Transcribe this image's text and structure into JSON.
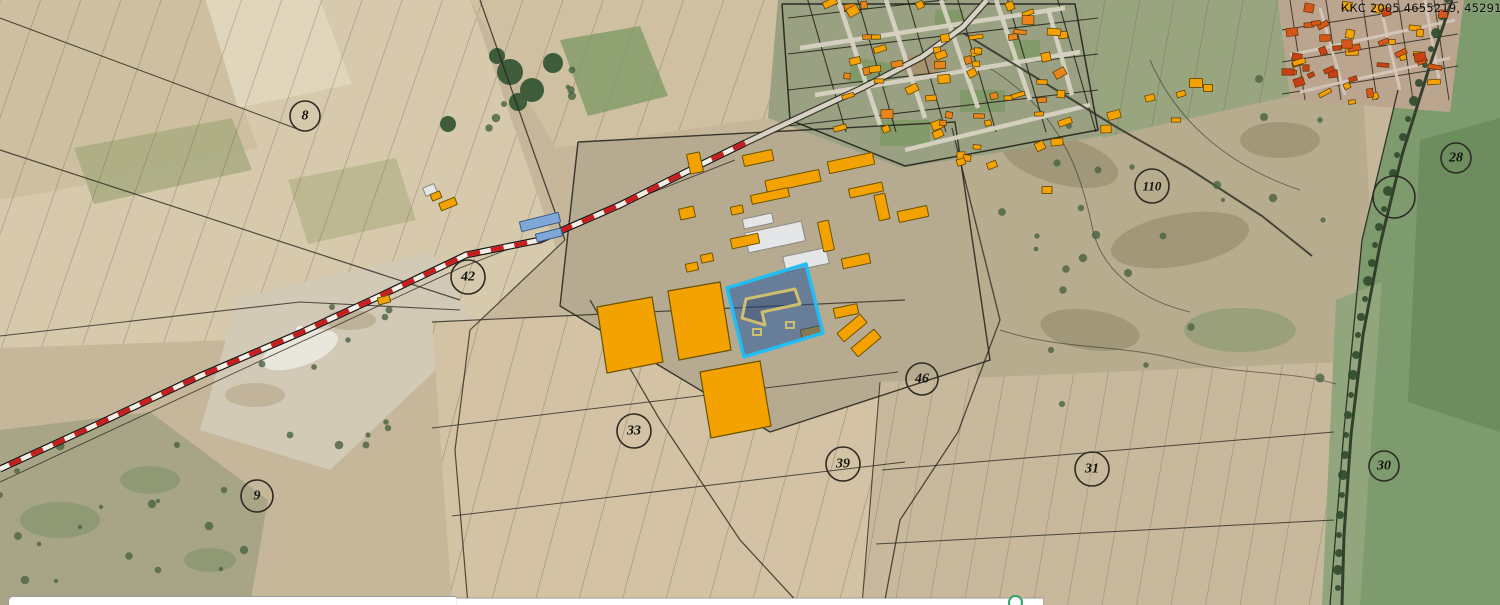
{
  "map": {
    "label_topright": "ККС 2005 4655219, 452916",
    "colors": {
      "building_orange": "#f3a202",
      "building_outline": "#6b5200",
      "town_building_red": "#d8551c",
      "white_shed": "#e4e6e7",
      "blue_shed": "#7fa8d9",
      "selection_stroke": "#22bdf2",
      "selection_fill": "rgba(25,80,160,0.5)",
      "inner_building_stroke": "#cdbf6e",
      "railway_red": "#c81e1e",
      "railway_light": "#f3efe6",
      "boundary": "#21201a",
      "circle_stroke": "#2d2b24",
      "circle_text": "#15140f"
    },
    "parcel_numbers": [
      {
        "label": "8",
        "x": 305,
        "y": 116,
        "r": 15
      },
      {
        "label": "42",
        "x": 468,
        "y": 277,
        "r": 17
      },
      {
        "label": "9",
        "x": 257,
        "y": 496,
        "r": 16
      },
      {
        "label": "33",
        "x": 634,
        "y": 431,
        "r": 17
      },
      {
        "label": "39",
        "x": 843,
        "y": 464,
        "r": 17
      },
      {
        "label": "46",
        "x": 922,
        "y": 379,
        "r": 16
      },
      {
        "label": "110",
        "x": 1152,
        "y": 186,
        "r": 17
      },
      {
        "label": "28",
        "x": 1456,
        "y": 158,
        "r": 15
      },
      {
        "label": "",
        "x": 1394,
        "y": 197,
        "r": 21
      },
      {
        "label": "31",
        "x": 1092,
        "y": 469,
        "r": 17
      },
      {
        "label": "30",
        "x": 1384,
        "y": 466,
        "r": 15
      }
    ],
    "selected_parcel": {
      "polygon": [
        [
          727,
          288
        ],
        [
          806,
          264
        ],
        [
          823,
          333
        ],
        [
          744,
          357
        ]
      ],
      "building_path": "M742,318 L746,299 L795,289 L800,304 L762,312 L765,325 Z",
      "marks": [
        [
          757,
          332
        ],
        [
          790,
          325
        ]
      ]
    },
    "railway_points": [
      [
        745,
        143
      ],
      [
        700,
        165
      ],
      [
        620,
        205
      ],
      [
        540,
        240
      ],
      [
        466,
        255
      ],
      [
        380,
        296
      ],
      [
        300,
        333
      ],
      [
        200,
        376
      ],
      [
        100,
        423
      ],
      [
        0,
        469
      ]
    ],
    "roads": {
      "main": [
        [
          745,
          143
        ],
        [
          802,
          116
        ],
        [
          862,
          88
        ],
        [
          922,
          57
        ],
        [
          963,
          27
        ],
        [
          987,
          0
        ]
      ],
      "east": [
        [
          963,
          33
        ],
        [
          1040,
          80
        ],
        [
          1118,
          128
        ],
        [
          1188,
          168
        ],
        [
          1262,
          216
        ],
        [
          1312,
          256
        ]
      ],
      "right": [
        [
          1452,
          0
        ],
        [
          1430,
          65
        ],
        [
          1402,
          155
        ],
        [
          1380,
          245
        ],
        [
          1363,
          335
        ],
        [
          1351,
          435
        ],
        [
          1344,
          535
        ],
        [
          1342,
          605
        ]
      ]
    },
    "village_streets": [
      [
        [
          838,
          0
        ],
        [
          880,
          125
        ]
      ],
      [
        [
          886,
          0
        ],
        [
          925,
          118
        ]
      ],
      [
        [
          941,
          0
        ],
        [
          978,
          108
        ]
      ],
      [
        [
          996,
          0
        ],
        [
          1030,
          100
        ]
      ],
      [
        [
          1048,
          8
        ],
        [
          1072,
          95
        ]
      ],
      [
        [
          800,
          48
        ],
        [
          1065,
          8
        ]
      ],
      [
        [
          815,
          95
        ],
        [
          1080,
          52
        ]
      ],
      [
        [
          905,
          150
        ],
        [
          1090,
          105
        ]
      ]
    ],
    "town_streets": [
      [
        [
          1290,
          55
        ],
        [
          1455,
          20
        ]
      ],
      [
        [
          1300,
          92
        ],
        [
          1450,
          58
        ]
      ],
      [
        [
          1320,
          8
        ],
        [
          1345,
          95
        ]
      ],
      [
        [
          1380,
          5
        ],
        [
          1400,
          90
        ]
      ],
      [
        [
          1425,
          0
        ],
        [
          1440,
          85
        ]
      ]
    ],
    "orange_parcels": [
      [
        [
          597,
          307
        ],
        [
          652,
          297
        ],
        [
          663,
          362
        ],
        [
          607,
          373
        ]
      ],
      [
        [
          668,
          291
        ],
        [
          720,
          282
        ],
        [
          731,
          350
        ],
        [
          679,
          360
        ]
      ],
      [
        [
          700,
          372
        ],
        [
          760,
          361
        ],
        [
          771,
          426
        ],
        [
          711,
          438
        ]
      ]
    ],
    "orange_sheds": [
      [
        695,
        163,
        13,
        20,
        -12
      ],
      [
        758,
        158,
        30,
        11,
        -12
      ],
      [
        793,
        181,
        55,
        12,
        -12
      ],
      [
        770,
        196,
        38,
        9,
        -12
      ],
      [
        851,
        163,
        46,
        12,
        -12
      ],
      [
        866,
        190,
        34,
        9,
        -12
      ],
      [
        882,
        207,
        11,
        26,
        -12
      ],
      [
        913,
        214,
        30,
        11,
        -12
      ],
      [
        687,
        213,
        15,
        11,
        -12
      ],
      [
        692,
        267,
        12,
        8,
        -12
      ],
      [
        707,
        258,
        12,
        8,
        -12
      ],
      [
        737,
        210,
        12,
        8,
        -12
      ],
      [
        826,
        236,
        11,
        30,
        -12
      ],
      [
        856,
        261,
        28,
        10,
        -12
      ],
      [
        745,
        241,
        28,
        10,
        -12
      ],
      [
        812,
        332,
        22,
        9,
        -12
      ],
      [
        846,
        311,
        24,
        10,
        -12
      ],
      [
        852,
        328,
        30,
        11,
        -40
      ],
      [
        866,
        343,
        30,
        11,
        -40
      ],
      [
        448,
        204,
        17,
        8,
        -22
      ],
      [
        436,
        196,
        10,
        7,
        -22
      ],
      [
        384,
        300,
        12,
        7,
        -15
      ],
      [
        1196,
        83,
        13,
        9,
        0
      ],
      [
        1208,
        88,
        9,
        7,
        0
      ],
      [
        1047,
        190,
        10,
        7,
        0
      ]
    ],
    "white_sheds": [
      [
        775,
        237,
        58,
        20,
        -12
      ],
      [
        806,
        260,
        44,
        16,
        -12
      ],
      [
        758,
        221,
        30,
        10,
        -12
      ],
      [
        430,
        190,
        12,
        9,
        -22
      ]
    ],
    "blue_sheds": [
      [
        540,
        222,
        40,
        10,
        -14
      ],
      [
        549,
        235,
        26,
        8,
        -14
      ]
    ],
    "house_clusters": [
      {
        "x": 816,
        "y": 2,
        "w": 250,
        "h": 128,
        "count": 55,
        "seed": 11,
        "palette": [
          "#f3a202",
          "#f3a202",
          "#e8851c"
        ]
      },
      {
        "x": 930,
        "y": 128,
        "w": 130,
        "h": 38,
        "count": 8,
        "seed": 5,
        "palette": [
          "#f3a202"
        ]
      },
      {
        "x": 1286,
        "y": 2,
        "w": 158,
        "h": 100,
        "count": 44,
        "seed": 23,
        "palette": [
          "#d8551c",
          "#f3a202",
          "#c93f16"
        ]
      },
      {
        "x": 1090,
        "y": 85,
        "w": 100,
        "h": 55,
        "count": 5,
        "seed": 3,
        "palette": [
          "#f3a202"
        ]
      }
    ]
  },
  "bottom_ui": {
    "left_panel_note": "",
    "center_bar_note": ""
  }
}
